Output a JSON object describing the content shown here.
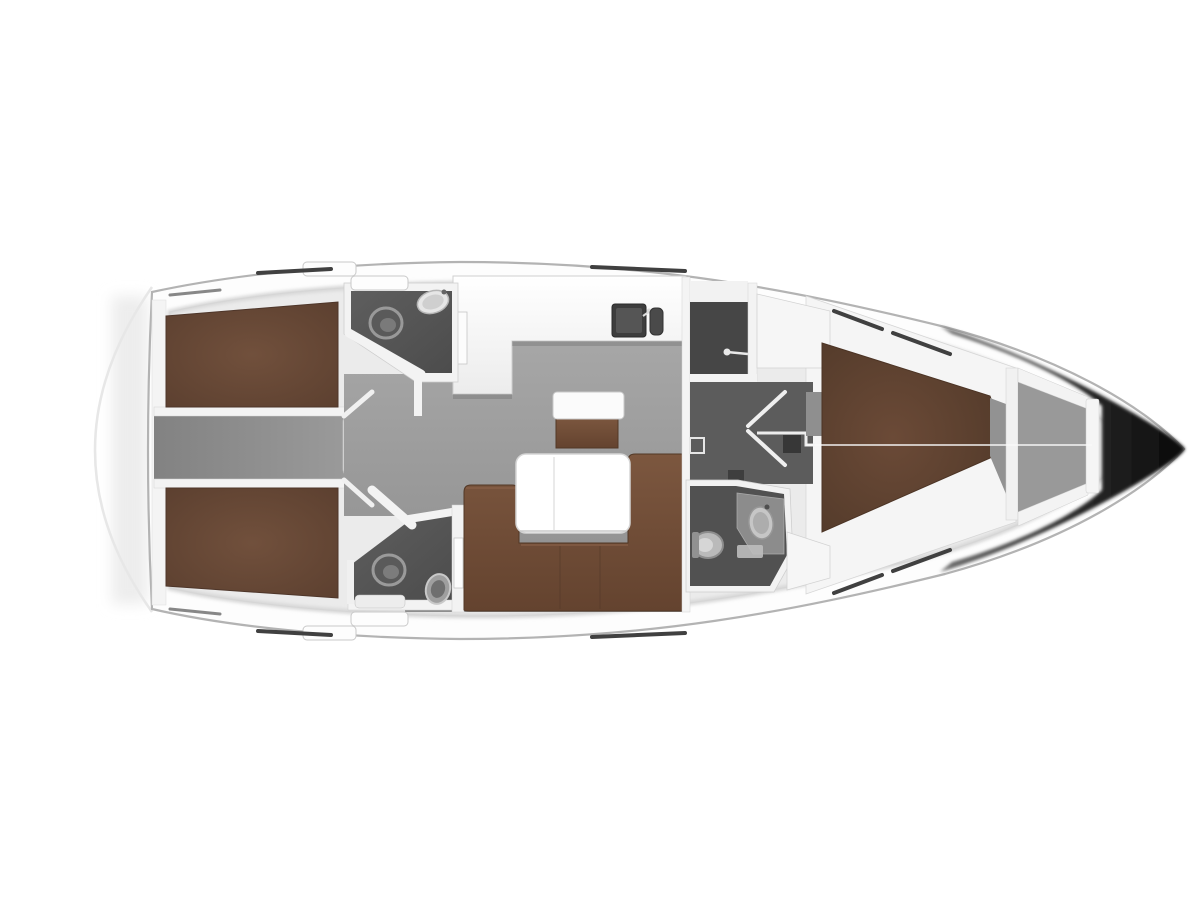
{
  "meta": {
    "title": "Sailing yacht interior layout plan",
    "type": "floor-plan",
    "view": "top-down",
    "orientation": "bow-right"
  },
  "colors": {
    "background": "#ffffff",
    "hull_fill": "#fdfdfd",
    "hull_stroke": "#b3b3b3",
    "stern_arc": "#e7e7e7",
    "interior_base": "#ebebeb",
    "interior_edge": "#c9c9c9",
    "wall_white": "#f3f3f3",
    "wall_stroke": "#cdcdcd",
    "floor_top": "#a7a7a7",
    "floor_bottom": "#8e8e8e",
    "corridor_dark": "#828282",
    "corridor_light": "#9a9a9a",
    "head_floor_light": "#5e5e5e",
    "head_floor_dark": "#4c4c4c",
    "compartment_dark": "#464646",
    "dressing_floor": "#5c5c5c",
    "day_head_floor": "#515151",
    "vanity_gray": "#8c8c8c",
    "berth_center": "#71503c",
    "berth_edge": "#5b3f2f",
    "berth_trim": "#4e362a",
    "forward_berth_center": "#6b4a37",
    "forward_berth_edge": "#4f3828",
    "sofa_top": "#7c573f",
    "sofa_bottom": "#64432f",
    "sofa_trim": "#523826",
    "counter_top": "#ffffff",
    "counter_bottom": "#ececec",
    "sink_basin": "#3d3d3d",
    "sink_inner": "#555555",
    "steps_light": "#e8e8e8",
    "steps_dark": "#c6c6c6",
    "step_rib": "#f2f2f2",
    "bow_shadow_start": "#6e6e6e",
    "bow_shadow_end": "#0a0a0a",
    "rail_dark": "#404040",
    "chain_locker_floor": "#999999",
    "cabin_floor_sliver": "#929292",
    "notch_gray": "#8f8f8f",
    "table_fill": "#ffffff",
    "fixture_light": "#e6e6e6",
    "fixture_mid": "#bababa",
    "toilet_dark": "#5a5a5a",
    "centerline": "#fafafa",
    "hatch_fill": "#fdfdfd"
  },
  "rooms": {
    "aft_cabin_port": {
      "label": "Aft double cabin (port)"
    },
    "aft_cabin_starboard": {
      "label": "Aft double cabin (starboard)"
    },
    "aft_head_port": {
      "label": "Aft head with toilet and washbasin (port)"
    },
    "aft_head_starboard": {
      "label": "Aft head with toilet and washbasin (starboard)"
    },
    "corridor": {
      "label": "Aft corridor between cabins"
    },
    "companionway": {
      "label": "Companionway steps"
    },
    "galley": {
      "label": "L-shaped galley with twin sinks"
    },
    "saloon": {
      "label": "Saloon with U-shaped sofa and table"
    },
    "dressing_area": {
      "label": "Dressing area with double doors"
    },
    "day_head": {
      "label": "Forward head with toilet and washbasin"
    },
    "forward_cabin": {
      "label": "Forward cabin with V-berth"
    },
    "anchor_locker": {
      "label": "Anchor locker"
    },
    "bow": {
      "label": "Bow"
    },
    "stern": {
      "label": "Stern with swim platform"
    }
  },
  "furniture": {
    "berth_port": {
      "label": "Double berth"
    },
    "berth_starboard": {
      "label": "Double berth"
    },
    "forward_berth": {
      "label": "V-berth"
    },
    "sofa": {
      "label": "U-shaped settee"
    },
    "table": {
      "label": "Saloon table"
    },
    "island_seat": {
      "label": "Island seat"
    },
    "galley_counter": {
      "label": "Galley worktop"
    },
    "steps": {
      "label": "Companionway steps"
    },
    "wardrobe": {
      "label": "Wardrobe locker"
    },
    "chart_locker": {
      "label": "Locker"
    }
  }
}
